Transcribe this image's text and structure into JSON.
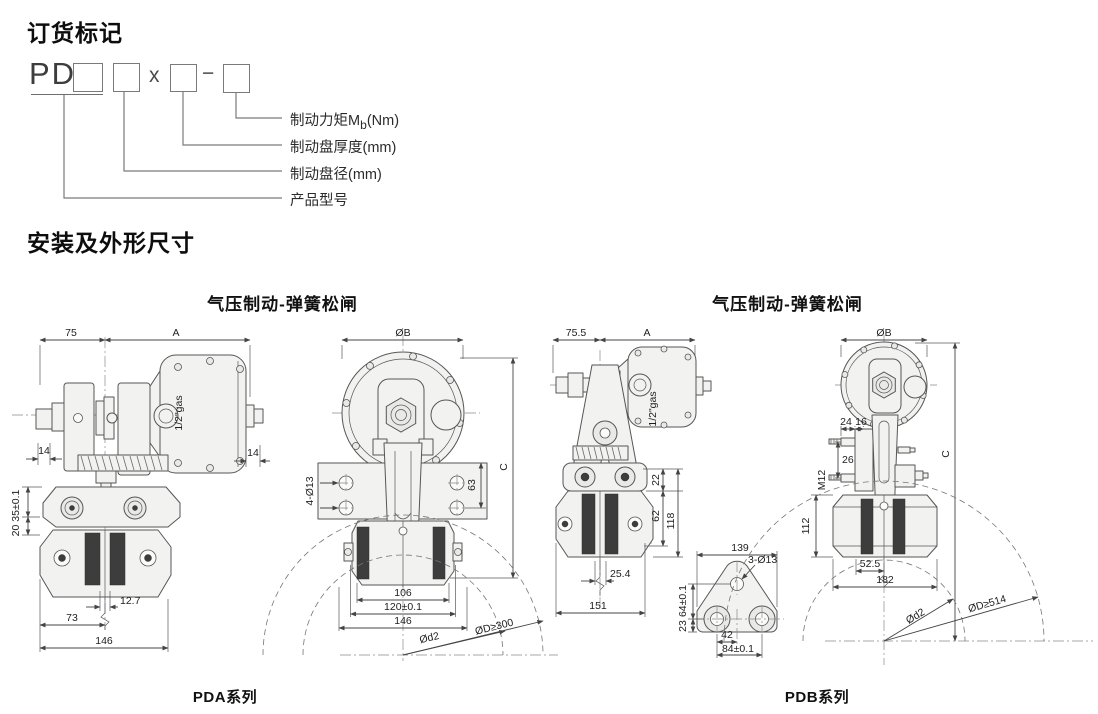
{
  "colors": {
    "line": "#565656",
    "part_fill": "#f2f2f0",
    "pad_dark": "#3d3d3d",
    "dim_line": "#444444",
    "text": "#1a1a1a"
  },
  "order": {
    "title": "订货标记",
    "prefix": "PD",
    "multiply": "x",
    "dash": "−",
    "callout_torque_main": "制动力矩M",
    "callout_torque_sub": "b",
    "callout_torque_tail": "(Nm)",
    "callout_thickness": "制动盘厚度(mm)",
    "callout_diameter": "制动盘径(mm)",
    "callout_model": "产品型号"
  },
  "section_title": "安装及外形尺寸",
  "pda": {
    "caption": "气压制动-弹簧松闸",
    "series": "PDA系列",
    "side": {
      "w75": "75",
      "wA": "A",
      "t14l": "14",
      "t14r": "14",
      "gas": "1/2\"gas",
      "v20_35": "20 35±0.1",
      "g12_7": "12.7",
      "w73": "73",
      "w146": "146"
    },
    "front": {
      "dB": "ØB",
      "hC": "C",
      "h63": "63",
      "holes": "4-Ø13",
      "w106": "106",
      "w120": "120±0.1",
      "w146": "146",
      "dd2": "Ød2",
      "dD": "ØD≥300"
    }
  },
  "pdb": {
    "caption": "气压制动-弹簧松闸",
    "series": "PDB系列",
    "side": {
      "w75_5": "75.5",
      "wA": "A",
      "gas": "1/2\"gas",
      "h22": "22",
      "h62": "62",
      "h118": "118",
      "g25_4": "25.4",
      "w151": "151"
    },
    "bracket": {
      "w139": "139",
      "holes": "3-Ø13",
      "h23": "23",
      "h64": "64±0.1",
      "w42": "42",
      "w84": "84±0.1"
    },
    "front": {
      "dB": "ØB",
      "hC": "C",
      "t24": "24",
      "t16": "16",
      "h26": "26",
      "m12": "M12",
      "h112": "112",
      "w52_5": "52.5",
      "w182": "182",
      "dd2": "Ød2",
      "dD": "ØD≥514"
    }
  }
}
